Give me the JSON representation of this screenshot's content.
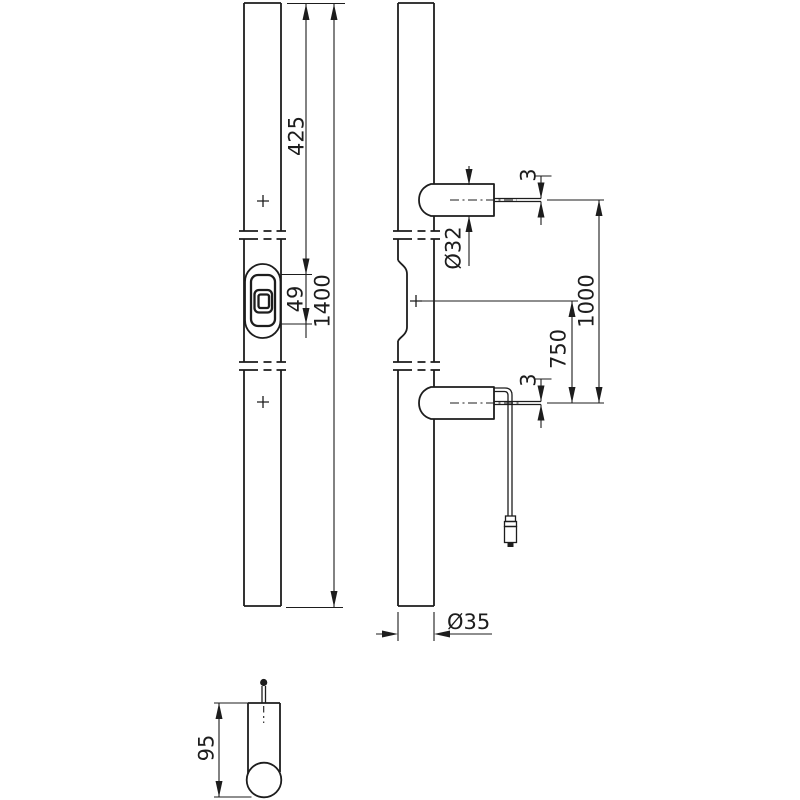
{
  "page": {
    "background": "#ffffff",
    "line_color": "#1d1d1d",
    "description_labels": {}
  },
  "dimensions": {
    "top_to_module": "425",
    "module_height": "49",
    "total_length": "1400",
    "post_diameter": "Ø32",
    "upper_mount_gap": "3",
    "post_spacing": "1000",
    "center_to_lower_post": "750",
    "lower_mount_gap": "3",
    "bar_diameter": "Ø35",
    "mount_projection": "95"
  }
}
